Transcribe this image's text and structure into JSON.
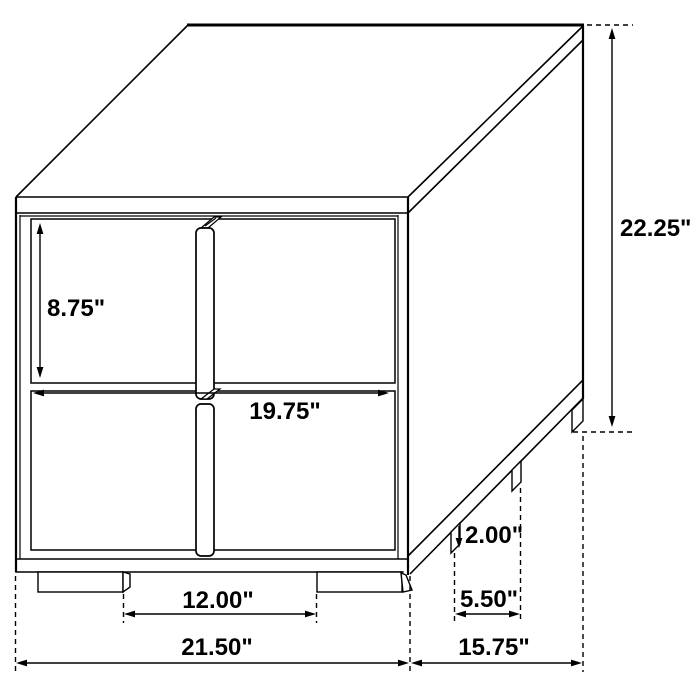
{
  "page": {
    "background_color": "#ffffff",
    "line_color": "#000000",
    "text_color": "#000000"
  },
  "dimensions": {
    "overall_height": "22.25\"",
    "drawer_height": "8.75\"",
    "drawer_width": "19.75\"",
    "foot_height": "2.00\"",
    "side_foot_spacing": "5.50\"",
    "front_foot_spacing": "12.00\"",
    "overall_width": "21.50\"",
    "overall_depth": "15.75\""
  }
}
